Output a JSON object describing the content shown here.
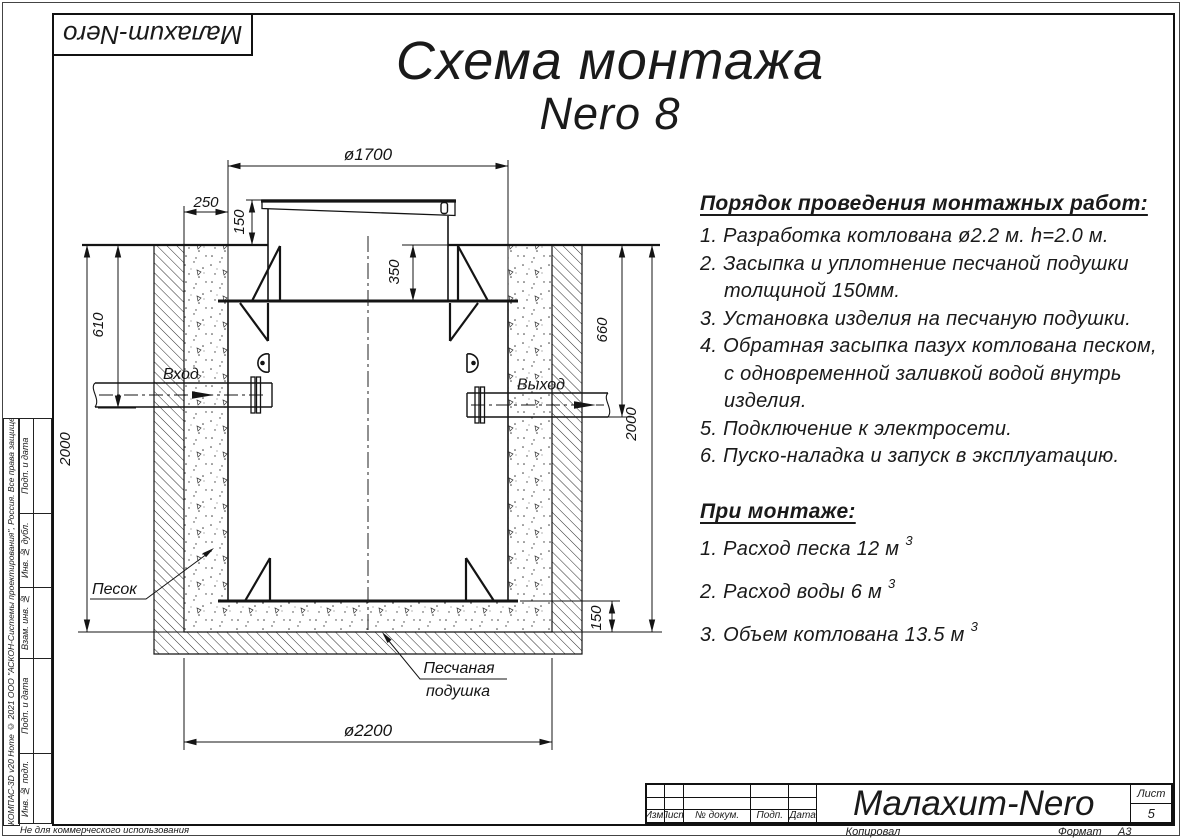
{
  "sheet": {
    "stamp_top_left": "Малахит-Nero",
    "watermark": "Не для коммерческого использования",
    "kompas_strip": "КОМПАС-3D v20 Home © 2021 ООО \"АСКОН-Системы проектирования\", Россия. Все права защищены.",
    "side_labels": [
      "Подп. и дата",
      "Инв. № дубл.",
      "Взам. инв. №",
      "Подп. и дата",
      "Инв. № подл."
    ]
  },
  "title": {
    "line1": "Схема монтажа",
    "line2": "Nero 8"
  },
  "drawing": {
    "dims": {
      "top_diameter": "ø1700",
      "sand_gap": "250",
      "lid_height": "150",
      "neck_depth": "350",
      "inlet_depth": "610",
      "outlet_depth": "660",
      "pit_depth_left": "2000",
      "pit_depth_right": "2000",
      "cushion_height": "150",
      "pit_diameter": "ø2200"
    },
    "labels": {
      "inlet": "Вход",
      "outlet": "Выход",
      "sand": "Песок",
      "cushion_line1": "Песчаная",
      "cushion_line2": "подушка"
    }
  },
  "instructions": {
    "heading": "Порядок проведения монтажных работ:",
    "lines": [
      {
        "text": "1. Разработка котлована ø2.2 м. h=2.0 м."
      },
      {
        "text": "2. Засыпка и уплотнение песчаной подушки"
      },
      {
        "text": "толщиной 150мм."
      },
      {
        "text": "3. Установка изделия на песчаную подушки."
      },
      {
        "text": "4. Обратная засыпка пазух котлована песком,"
      },
      {
        "text": "с одновременной заливкой водой внутрь"
      },
      {
        "text": "изделия."
      },
      {
        "text": "5. Подключение к электросети."
      },
      {
        "text": "6. Пуско-наладка и запуск в эксплуатацию."
      }
    ]
  },
  "montage": {
    "heading": "При монтаже:",
    "items": [
      {
        "text": "1. Расход песка 12 м",
        "sup": "3"
      },
      {
        "text": "2. Расход воды 6 м",
        "sup": "3"
      },
      {
        "text": "3. Объем котлована 13.5 м",
        "sup": "3"
      }
    ]
  },
  "title_block": {
    "columns": [
      "Изм.",
      "Лист",
      "№ докум.",
      "Подп.",
      "Дата"
    ],
    "doc_title": "Малахит-Nero",
    "sheet_label": "Лист",
    "sheet_number": "5",
    "copied_by": "Копировал",
    "format_label": "Формат",
    "format_value": "А3"
  }
}
